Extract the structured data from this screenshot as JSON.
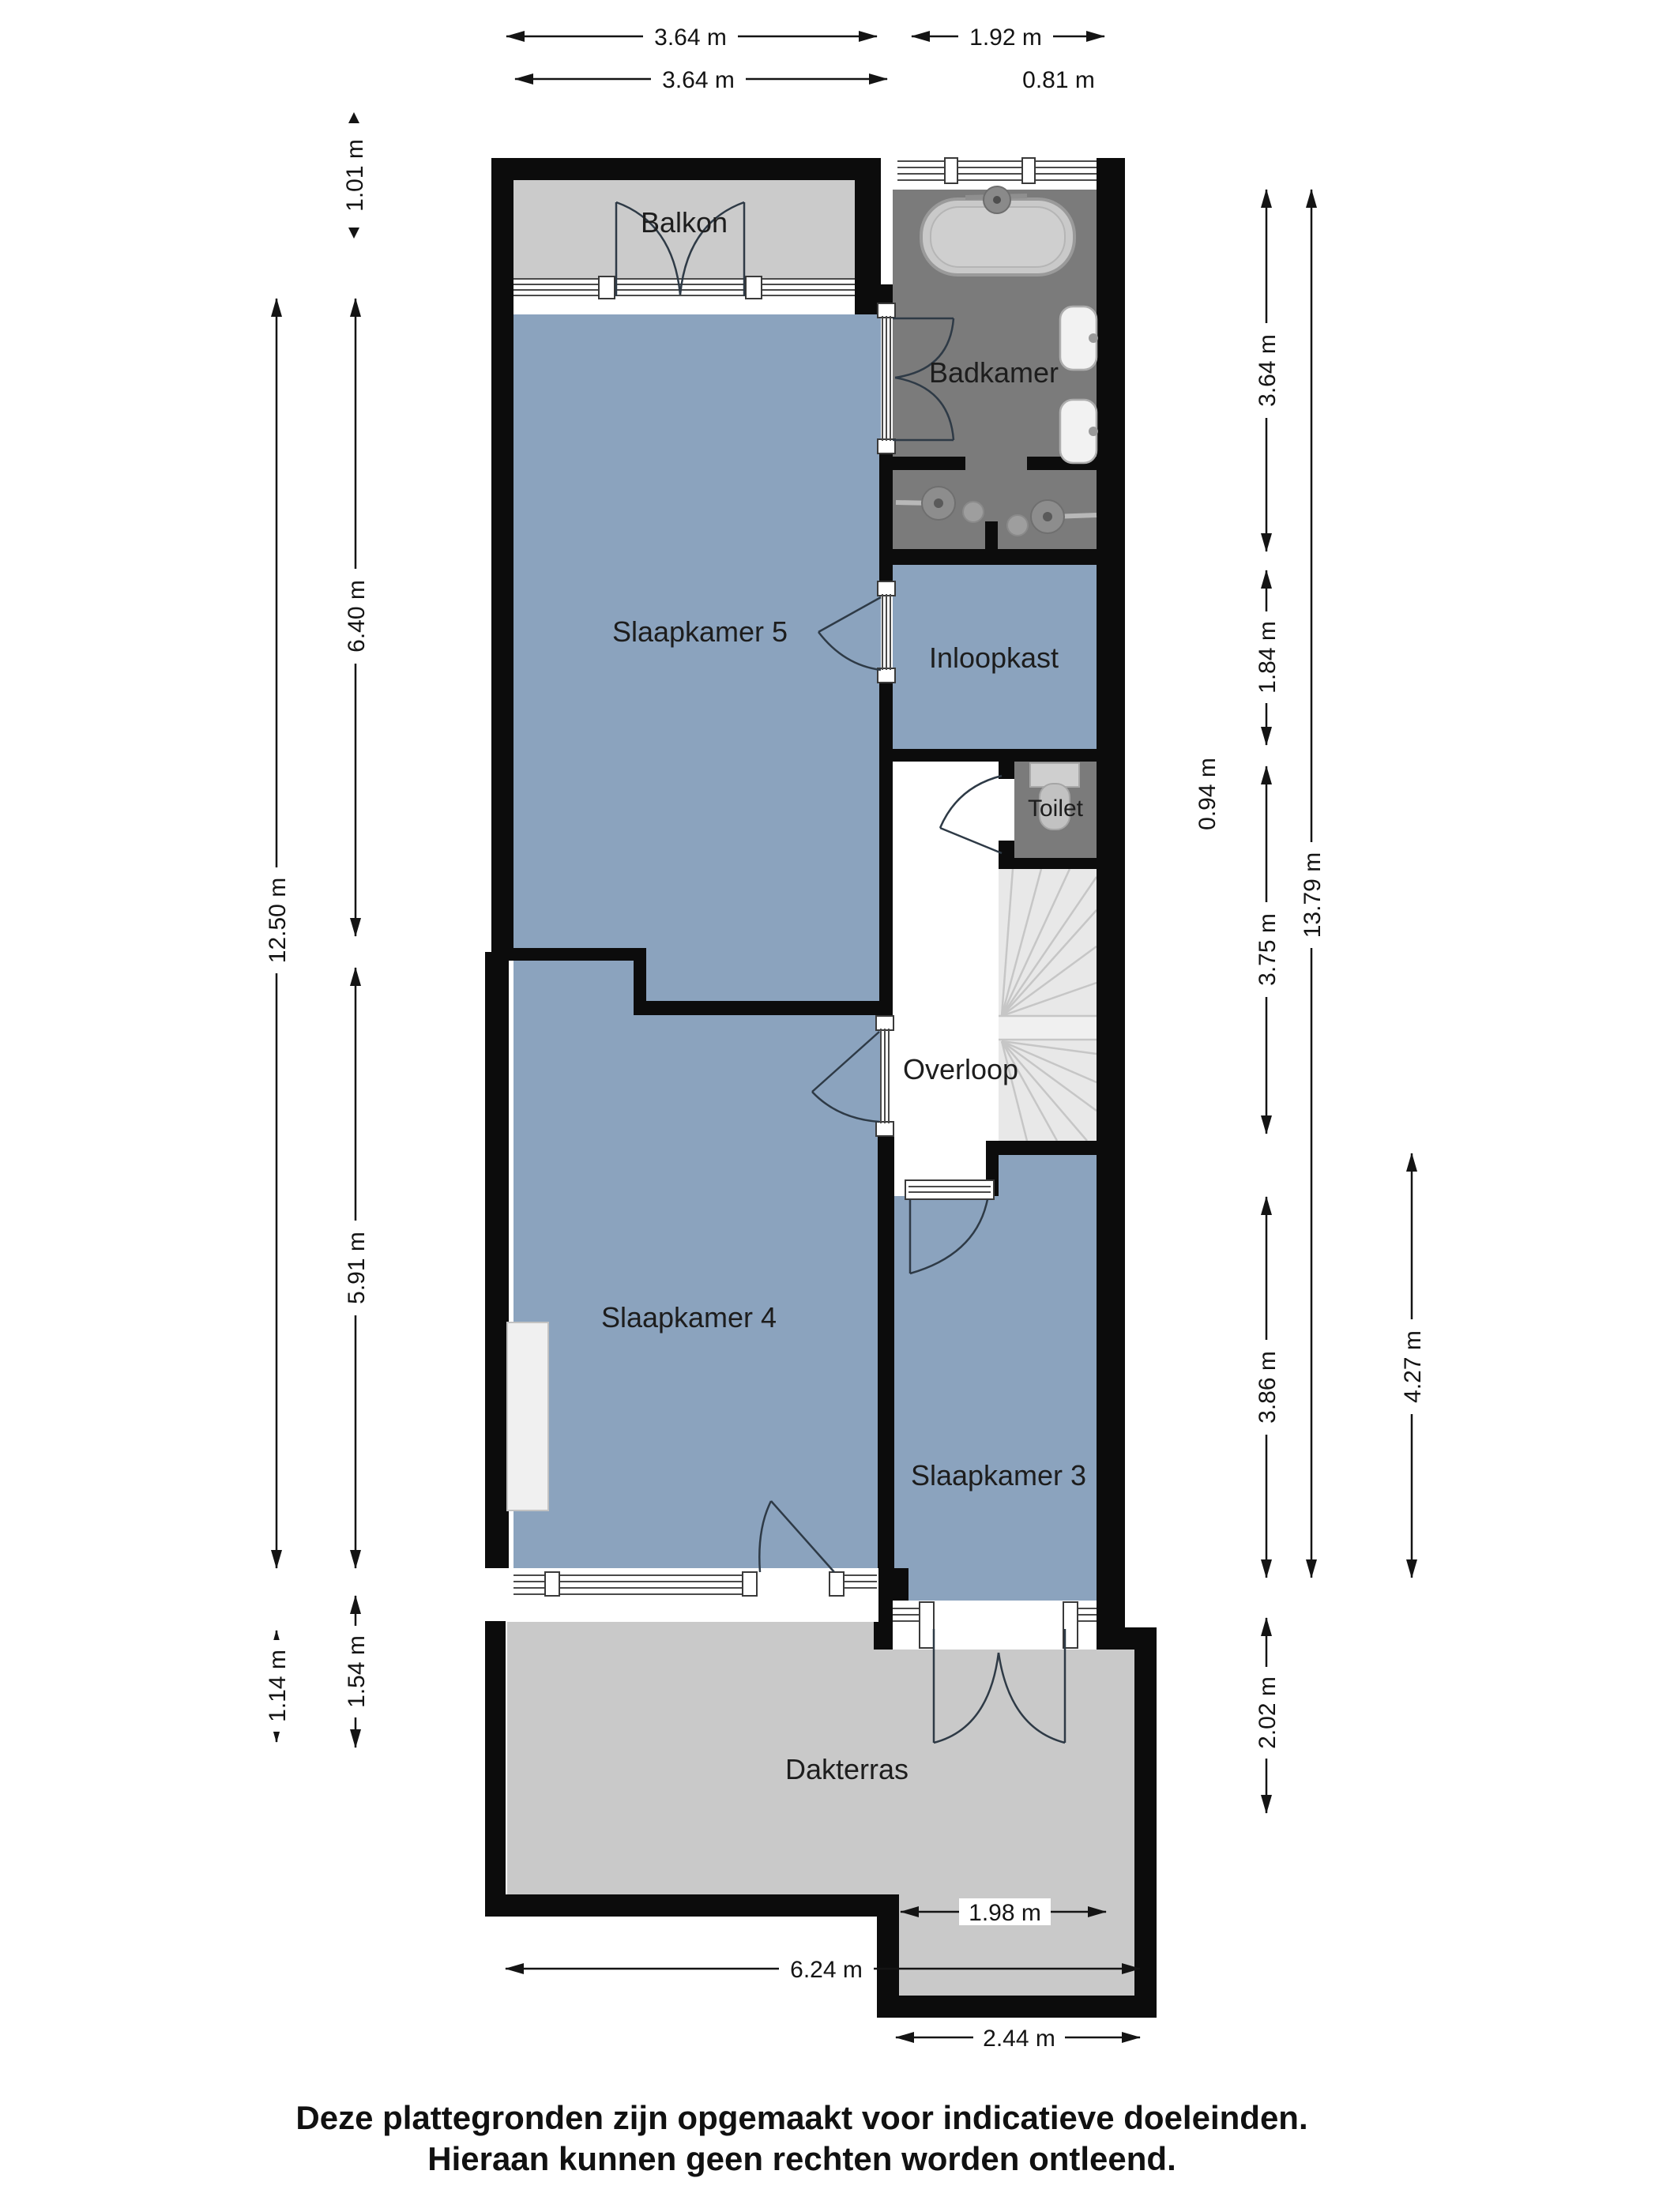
{
  "plan": {
    "rooms": {
      "balkon": {
        "label": "Balkon"
      },
      "badkamer": {
        "label": "Badkamer"
      },
      "slaapkamer5": {
        "label": "Slaapkamer 5"
      },
      "inloopkast": {
        "label": "Inloopkast"
      },
      "toilet": {
        "label": "Toilet"
      },
      "overloop": {
        "label": "Overloop"
      },
      "slaapkamer4": {
        "label": "Slaapkamer 4"
      },
      "slaapkamer3": {
        "label": "Slaapkamer 3"
      },
      "dakterras": {
        "label": "Dakterras"
      }
    },
    "dimensions": {
      "top": {
        "balkon_outer": "3.64 m",
        "badkamer_w": "1.92 m",
        "balkon_inner": "3.64 m",
        "offset": "0.81 m"
      },
      "left": {
        "balkon_depth": "1.01 m",
        "sk5_h": "6.40 m",
        "total_h": "12.50 m",
        "sk4_h": "5.91 m",
        "terras_step": "1.54 m",
        "terras_edge": "1.14 m"
      },
      "right": {
        "badkamer_h": "3.64 m",
        "inloopkast_h": "1.84 m",
        "toilet_h": "0.94 m",
        "overloop_h": "3.75 m",
        "total_h": "13.79 m",
        "sk3_h": "3.86 m",
        "sk3_full": "4.27 m",
        "terras_h": "2.02 m"
      },
      "bottom": {
        "doors_w": "1.98 m",
        "total_w": "6.24 m",
        "terras_w": "2.44 m"
      }
    }
  },
  "footer": {
    "line1": "Deze plattegronden zijn opgemaakt voor indicatieve doeleinden.",
    "line2": "Hieraan kunnen geen rechten worden ontleend."
  },
  "colors": {
    "room_blue": "#8BA3BE",
    "floor_gray": "#CBCBCB",
    "terras_gray": "#C9C9C9",
    "wet_gray": "#7B7B7B",
    "wall_black": "#0C0C0C",
    "stairs_gray": "#E8E8E8"
  }
}
